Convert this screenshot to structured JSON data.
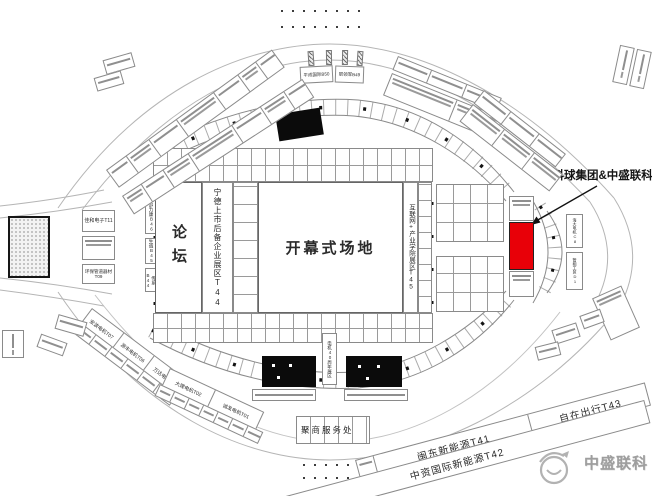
{
  "annotation": {
    "label": "兴科球集团&中盛联科"
  },
  "halls": {
    "forum": "论坛",
    "t44": "宁德上市后备企业展区T44",
    "ceremony": "开幕式场地",
    "t45": "互联网+产业学院展区T45"
  },
  "west": {
    "t11": "佳和电子T11",
    "t09": "环保管道器材T09",
    "b46": "舒力康B46",
    "b45": "生诚B45",
    "b44": "传系B44"
  },
  "north": {
    "b50": "平成国际B50",
    "b49": "职领军B49"
  },
  "southwest": {
    "t07": "安波电机T07",
    "t06": "源丰电机T06",
    "t05": "万达电机T05",
    "t02": "大理电机T02",
    "t01": "诚发电机T01"
  },
  "east": {
    "c8": "海大电机C8",
    "d1": "管相工贸D1"
  },
  "center": {
    "anniversary": "电机40周年展区",
    "service": "聚商服务处"
  },
  "southeast": {
    "t41": "闽东新能源T41",
    "t43": "自在出行T43",
    "t42": "中资国际新能源T42"
  },
  "logo": {
    "text": "中盛联科"
  },
  "colors": {
    "highlight": "#e80008",
    "black_booth": "#0b0b0b",
    "logo_gray": "#9e9e9e"
  }
}
